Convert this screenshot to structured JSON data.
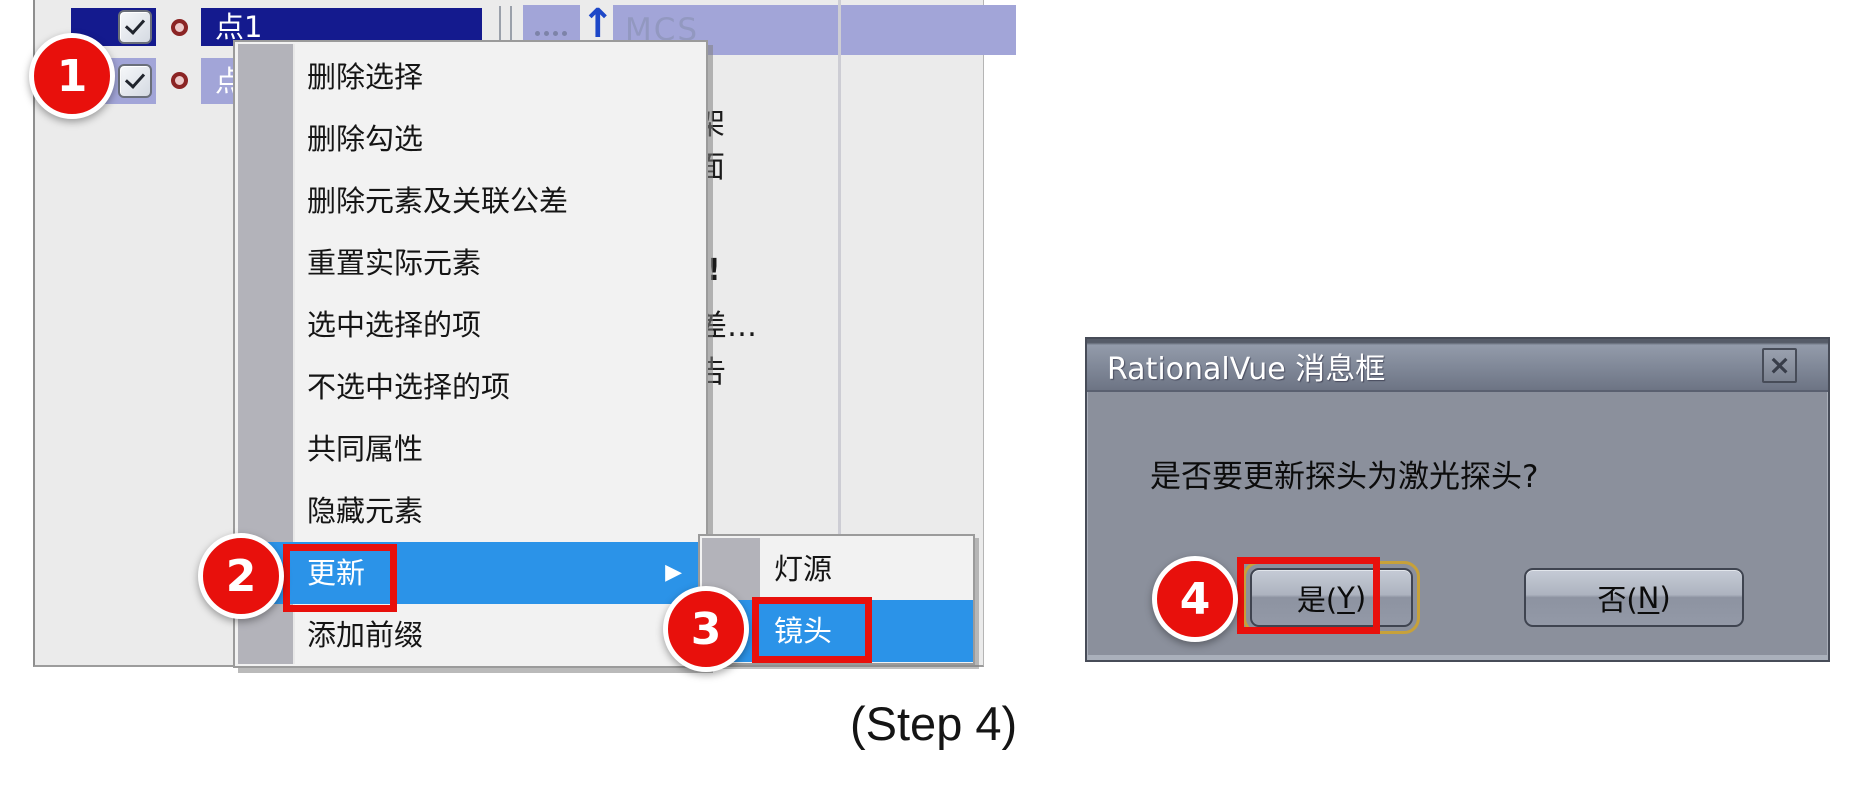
{
  "colors": {
    "annotation_red": "#e8100c",
    "accent_blue": "#2b93e8",
    "navy": "#141a8e",
    "lavender": "#a2a5d8",
    "panel_bg": "#ebebeb",
    "menu_bg": "#f2f2f2",
    "gutter": "#b3b3ba",
    "dialog_body": "#8b909c"
  },
  "tree": {
    "header_label": "MCS",
    "items": [
      {
        "label": "点1",
        "checked": true
      },
      {
        "label": "点2",
        "checked": true
      }
    ],
    "fragments": [
      "架",
      "面",
      "!",
      "差…",
      "告"
    ]
  },
  "context_menu": {
    "items": [
      "删除选择",
      "删除勾选",
      "删除元素及关联公差",
      "重置实际元素",
      "选中选择的项",
      "不选中选择的项",
      "共同属性",
      "隐藏元素",
      "更新",
      "添加前缀"
    ],
    "highlighted": "更新",
    "submenu_arrow": "▶"
  },
  "submenu": {
    "items": [
      "灯源",
      "镜头"
    ],
    "highlighted": "镜头"
  },
  "dialog": {
    "title": "RationalVue 消息框",
    "close_glyph": "×",
    "message": "是否要更新探头为激光探头?",
    "buttons": {
      "yes": {
        "pre": "是(",
        "key": "Y",
        "post": ")"
      },
      "no": {
        "pre": "否(",
        "key": "N",
        "post": ")"
      }
    }
  },
  "annotations": {
    "badges": [
      "1",
      "2",
      "3",
      "4"
    ],
    "caption": "(Step 4)"
  }
}
